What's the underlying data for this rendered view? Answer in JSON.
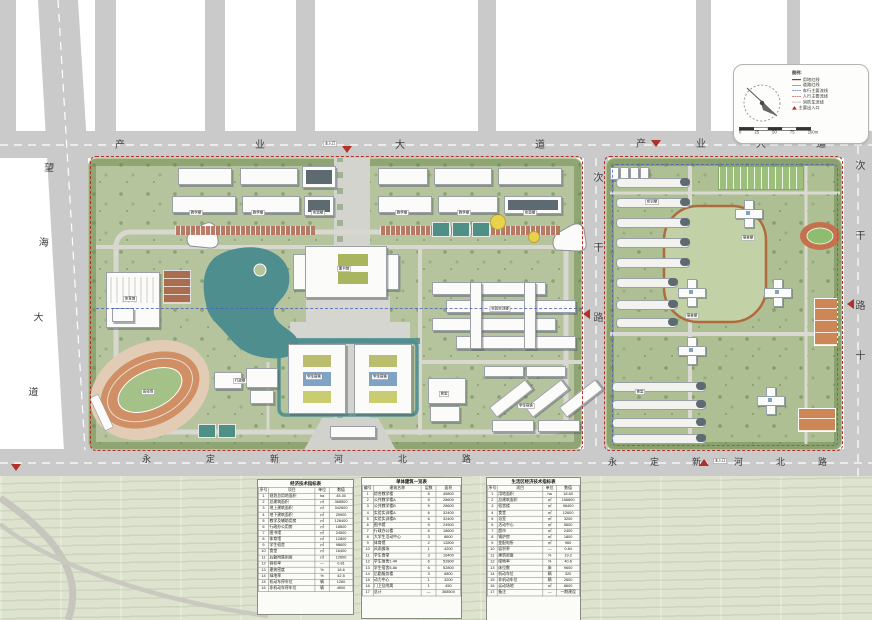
{
  "palette": {
    "boundary_red": "#b03127",
    "water_teal": "#4e8e8f",
    "campus_green": "#b6c49e",
    "road_gray": "#cacaca",
    "track_orange": "#cf8f66",
    "axis_blue": "#4a5fc1"
  },
  "roads": {
    "top_left": "产业大道",
    "top_right": "产业大道",
    "left": "望海大道",
    "middle": "次干路",
    "right": "次干路",
    "right_extra": "十",
    "bottom_left": "永定新河北路",
    "bottom_right": "永定新河北路"
  },
  "entrances": {
    "main_top": "主入口",
    "main_bottom": "主入口"
  },
  "legend": {
    "title": "图例:",
    "items": [
      {
        "label": "用地红线",
        "swatch": "solid-red"
      },
      {
        "label": "道路红线",
        "swatch": "solid-brown"
      },
      {
        "label": "车行主要流线",
        "swatch": "dash-blue"
      },
      {
        "label": "人行主要流线",
        "swatch": "dash-red"
      },
      {
        "label": "消防车流线",
        "swatch": "dot-gray"
      },
      {
        "label": "主要出入口",
        "swatch": "tri-red"
      }
    ]
  },
  "scalebar": {
    "ticks": [
      "0",
      "25",
      "50",
      "75",
      "100m"
    ]
  },
  "building_labels": [
    "教学楼",
    "教学楼",
    "实验楼",
    "教学楼",
    "教学楼",
    "实验楼",
    "图书馆",
    "体育馆",
    "田径场",
    "学生宿舍",
    "学生宿舍",
    "实验实训楼",
    "食堂",
    "学生宿舍",
    "行政楼",
    "宿舍楼",
    "宿舍楼",
    "食堂",
    "实训楼"
  ],
  "tables": [
    {
      "title": "经济技术指标表",
      "headers": [
        "序号",
        "项目",
        "单位",
        "数值"
      ],
      "rows": [
        [
          "1",
          "规划总用地面积",
          "ha",
          "45.30"
        ],
        [
          "2",
          "总建筑面积",
          "㎡",
          "368500"
        ],
        [
          "3",
          "地上建筑面积",
          "㎡",
          "342600"
        ],
        [
          "4",
          "地下建筑面积",
          "㎡",
          "25900"
        ],
        [
          "5",
          "教学及辅助用房",
          "㎡",
          "126400"
        ],
        [
          "6",
          "行政办公用房",
          "㎡",
          "18600"
        ],
        [
          "7",
          "图书馆",
          "㎡",
          "24500"
        ],
        [
          "8",
          "体育馆",
          "㎡",
          "12800"
        ],
        [
          "9",
          "学生宿舍",
          "㎡",
          "98600"
        ],
        [
          "10",
          "食堂",
          "㎡",
          "16400"
        ],
        [
          "11",
          "后勤附属用房",
          "㎡",
          "12600"
        ],
        [
          "12",
          "容积率",
          "—",
          "0.81"
        ],
        [
          "13",
          "建筑密度",
          "%",
          "18.6"
        ],
        [
          "14",
          "绿地率",
          "%",
          "42.5"
        ],
        [
          "15",
          "机动车停车位",
          "辆",
          "1260"
        ],
        [
          "16",
          "非机动车停车位",
          "辆",
          "4500"
        ]
      ]
    },
    {
      "title": "单体建筑一览表",
      "headers": [
        "编号",
        "建筑名称",
        "层数",
        "面积"
      ],
      "rows": [
        [
          "1",
          "综合教学楼",
          "5",
          "45800"
        ],
        [
          "2",
          "公共教学楼A",
          "5",
          "28600"
        ],
        [
          "3",
          "公共教学楼B",
          "5",
          "28600"
        ],
        [
          "4",
          "实验实训楼A",
          "6",
          "32400"
        ],
        [
          "5",
          "实验实训楼B",
          "6",
          "32400"
        ],
        [
          "6",
          "图书馆",
          "5",
          "24500"
        ],
        [
          "7",
          "行政办公楼",
          "6",
          "18600"
        ],
        [
          "8",
          "大学生活动中心",
          "3",
          "8600"
        ],
        [
          "9",
          "体育馆",
          "2",
          "12800"
        ],
        [
          "10",
          "风雨操场",
          "1",
          "4200"
        ],
        [
          "11",
          "学生食堂",
          "3",
          "16400"
        ],
        [
          "12",
          "学生宿舍1-4#",
          "6",
          "52800"
        ],
        [
          "13",
          "学生宿舍5-8#",
          "6",
          "52800"
        ],
        [
          "14",
          "后勤服务楼",
          "3",
          "6800"
        ],
        [
          "15",
          "动力中心",
          "1",
          "3200"
        ],
        [
          "16",
          "门卫及附属",
          "1",
          "450"
        ],
        [
          "17",
          "总计",
          "—",
          "368500"
        ]
      ]
    },
    {
      "title": "生活区经济技术指标表",
      "headers": [
        "序号",
        "项目",
        "单位",
        "数值"
      ],
      "rows": [
        [
          "1",
          "用地面积",
          "ha",
          "18.60"
        ],
        [
          "2",
          "总建筑面积",
          "㎡",
          "156800"
        ],
        [
          "3",
          "宿舍楼",
          "㎡",
          "98400"
        ],
        [
          "4",
          "食堂",
          "㎡",
          "12600"
        ],
        [
          "5",
          "浴室",
          "㎡",
          "3200"
        ],
        [
          "6",
          "活动中心",
          "㎡",
          "5600"
        ],
        [
          "7",
          "超市",
          "㎡",
          "2400"
        ],
        [
          "8",
          "锅炉房",
          "㎡",
          "1800"
        ],
        [
          "9",
          "变配电所",
          "㎡",
          "960"
        ],
        [
          "10",
          "容积率",
          "—",
          "0.84"
        ],
        [
          "11",
          "建筑密度",
          "%",
          "19.2"
        ],
        [
          "12",
          "绿地率",
          "%",
          "40.6"
        ],
        [
          "13",
          "床位数",
          "床",
          "9600"
        ],
        [
          "14",
          "机动车位",
          "辆",
          "320"
        ],
        [
          "15",
          "非机动车位",
          "辆",
          "2600"
        ],
        [
          "16",
          "运动场地",
          "㎡",
          "8600"
        ],
        [
          "17",
          "备注",
          "—",
          "一期建设"
        ]
      ]
    }
  ]
}
